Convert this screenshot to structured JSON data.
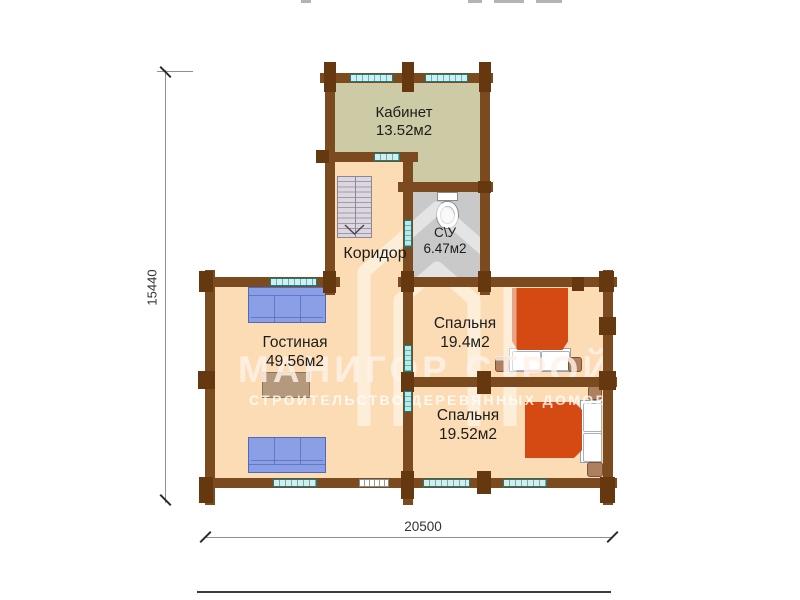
{
  "watermark": {
    "brand": "МАНИГОР СТРОЙ",
    "tagline": "СТРОИТЕЛЬСТВО ДЕРЕВЯННЫХ ДОМОВ"
  },
  "dimensions": {
    "height": "15440",
    "width": "20500"
  },
  "rooms": {
    "kabinet": {
      "name": "Кабинет",
      "area": "13.52м2"
    },
    "su": {
      "name": "С\\У",
      "area": "6.47м2"
    },
    "koridor": {
      "name": "Коридор"
    },
    "gostinaya": {
      "name": "Гостиная",
      "area": "49.56м2"
    },
    "spalnya1": {
      "name": "Спальня",
      "area": "19.4м2"
    },
    "spalnya2": {
      "name": "Спальня",
      "area": "19.52м2"
    }
  },
  "colors": {
    "wall": "#7b4a1e",
    "log_end": "#663810",
    "floor_wood": "#fbdcb5",
    "floor_office": "#cdcba5",
    "floor_bath": "#c9c9c9",
    "window_fill": "#d2eef0",
    "window_border": "#177f82",
    "door_fill": "#bfe7e3",
    "sofa": "#8b9fe6",
    "sofa_border": "#5168bb",
    "bed": "#d54a12",
    "table": "#b5997d",
    "table_border": "#8d7357",
    "stairs": "#dcd6de",
    "dim": "#8f8f8f",
    "label": "#1c1c1c",
    "watermark": "#fff2ea"
  }
}
